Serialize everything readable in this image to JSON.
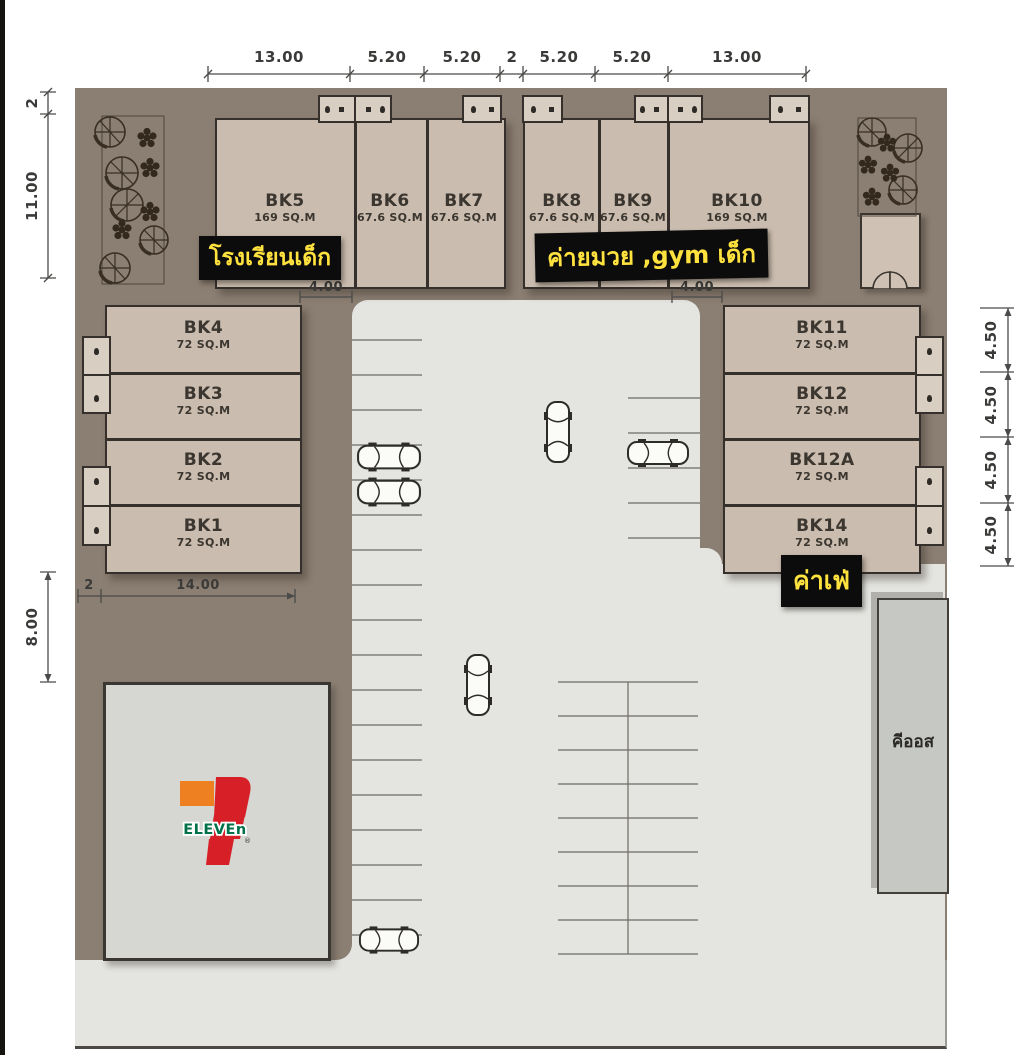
{
  "labels": {
    "school": "โรงเรียนเด็ก",
    "gym": "ค่ายมวย ,gym เด็ก",
    "cafe": "ค่าเฟ่",
    "kiosk": "คีออส"
  },
  "seven_eleven": {
    "wordmark": "ELEVEn",
    "registered": "®"
  },
  "units": {
    "bk5": {
      "name": "BK5",
      "area": "169 SQ.M"
    },
    "bk6": {
      "name": "BK6",
      "area": "67.6 SQ.M"
    },
    "bk7": {
      "name": "BK7",
      "area": "67.6 SQ.M"
    },
    "bk8": {
      "name": "BK8",
      "area": "67.6 SQ.M"
    },
    "bk9": {
      "name": "BK9",
      "area": "67.6 SQ.M"
    },
    "bk10": {
      "name": "BK10",
      "area": "169 SQ.M"
    },
    "bk4": {
      "name": "BK4",
      "area": "72 SQ.M"
    },
    "bk3": {
      "name": "BK3",
      "area": "72 SQ.M"
    },
    "bk2": {
      "name": "BK2",
      "area": "72 SQ.M"
    },
    "bk1": {
      "name": "BK1",
      "area": "72 SQ.M"
    },
    "bk11": {
      "name": "BK11",
      "area": "72 SQ.M"
    },
    "bk12": {
      "name": "BK12",
      "area": "72 SQ.M"
    },
    "bk12a": {
      "name": "BK12A",
      "area": "72 SQ.M"
    },
    "bk14": {
      "name": "BK14",
      "area": "72 SQ.M"
    }
  },
  "dims": {
    "top": [
      "13.00",
      "5.20",
      "5.20",
      "2",
      "5.20",
      "5.20",
      "13.00"
    ],
    "left_upper": [
      "2",
      "11.00"
    ],
    "left_lower": "8.00",
    "bottom_inner": [
      "2",
      "14.00"
    ],
    "right": [
      "4.50",
      "4.50",
      "4.50",
      "4.50"
    ],
    "gap_left": "4.00",
    "gap_right": "4.00"
  },
  "colors": {
    "plan_bg": "#8b7e72",
    "building_fill": "#cabcae",
    "building_border": "#35302b",
    "parking": "#e4e4e0",
    "label_bg": "#0c0c0c",
    "label_text": "#ffe23e",
    "seven_orange": "#ef8022",
    "seven_red": "#d71f27",
    "seven_green": "#00724a",
    "dim_text": "#3a3a38"
  }
}
